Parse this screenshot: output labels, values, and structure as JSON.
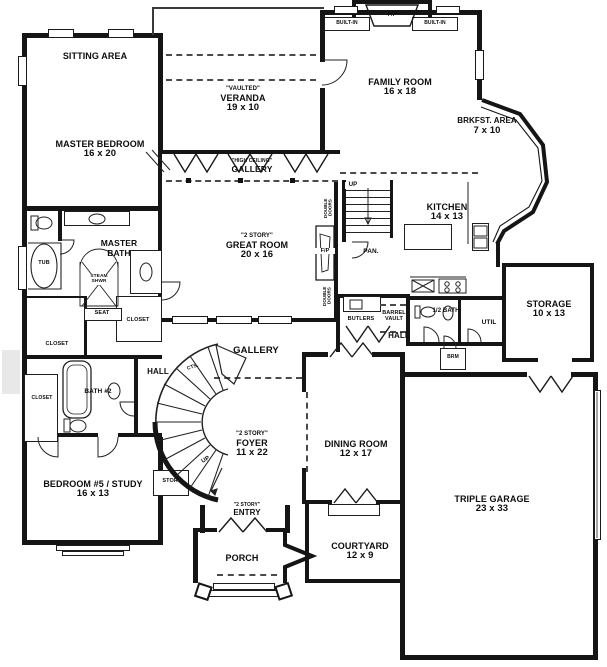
{
  "plan": {
    "title": "First floor plan",
    "rooms": {
      "sitting_area": {
        "name": "SITTING AREA"
      },
      "master_bedroom": {
        "name": "MASTER BEDROOM",
        "dims": "16 x 20"
      },
      "veranda": {
        "qualifier": "\"VAULTED\"",
        "name": "VERANDA",
        "dims": "19 x 10"
      },
      "family_room": {
        "name": "FAMILY ROOM",
        "dims": "16 x 18"
      },
      "brkfst_area": {
        "name": "BRKFST. AREA",
        "dims": "7 x 10"
      },
      "gallery_upper": {
        "qualifier": "\"HIGH CEILING\"",
        "name": "GALLERY"
      },
      "great_room": {
        "qualifier": "\"2 STORY\"",
        "name": "GREAT ROOM",
        "dims": "20 x 16"
      },
      "kitchen": {
        "name": "KITCHEN",
        "dims": "14 x 13"
      },
      "master_bath": {
        "name": "MASTER BATH"
      },
      "storage": {
        "name": "STORAGE",
        "dims": "10 x 13"
      },
      "gallery_lower": {
        "name": "GALLERY"
      },
      "foyer": {
        "qualifier": "\"2 STORY\"",
        "name": "FOYER",
        "dims": "11 x 22"
      },
      "dining_room": {
        "name": "DINING ROOM",
        "dims": "12 x 17"
      },
      "bedroom5": {
        "name": "BEDROOM #5 / STUDY",
        "dims": "16 x 13"
      },
      "triple_garage": {
        "name": "TRIPLE GARAGE",
        "dims": "23 x 33"
      },
      "courtyard": {
        "name": "COURTYARD",
        "dims": "12 x 9"
      },
      "entry": {
        "qualifier": "\"2 STORY\"",
        "name": "ENTRY"
      },
      "porch": {
        "name": "PORCH"
      }
    },
    "fixtures": {
      "built_in_left": "BUILT-IN",
      "built_in_right": "BUILT-IN",
      "fp_family": "F/P",
      "fp_great": "F/P",
      "up_back_stairs": "UP",
      "up_main_stairs": "UP",
      "pantry": "PAN.",
      "butlers": "BUTLERS",
      "barrel_vault": "BARREL VAULT",
      "half_bath": "1/2 BATH",
      "util": "UTIL",
      "brm": "BRM",
      "hall_left": "HALL",
      "hall_right": "HALL",
      "tub": "TUB",
      "steam_shwr": "STEAM SHWR",
      "seat": "SEAT",
      "closet_master_1": "CLOSET",
      "closet_master_2": "CLOSET",
      "closet_bath2": "CLOSET",
      "bath2": "BATH #2",
      "cts": "CTS.",
      "stor": "STOR.",
      "double_doors_upper": "DOUBLE DOORS",
      "double_doors_lower": "DOUBLE DOORS"
    },
    "colors": {
      "wall": "#151515",
      "paper": "#ffffff",
      "dash": "#4a4a4a"
    }
  }
}
